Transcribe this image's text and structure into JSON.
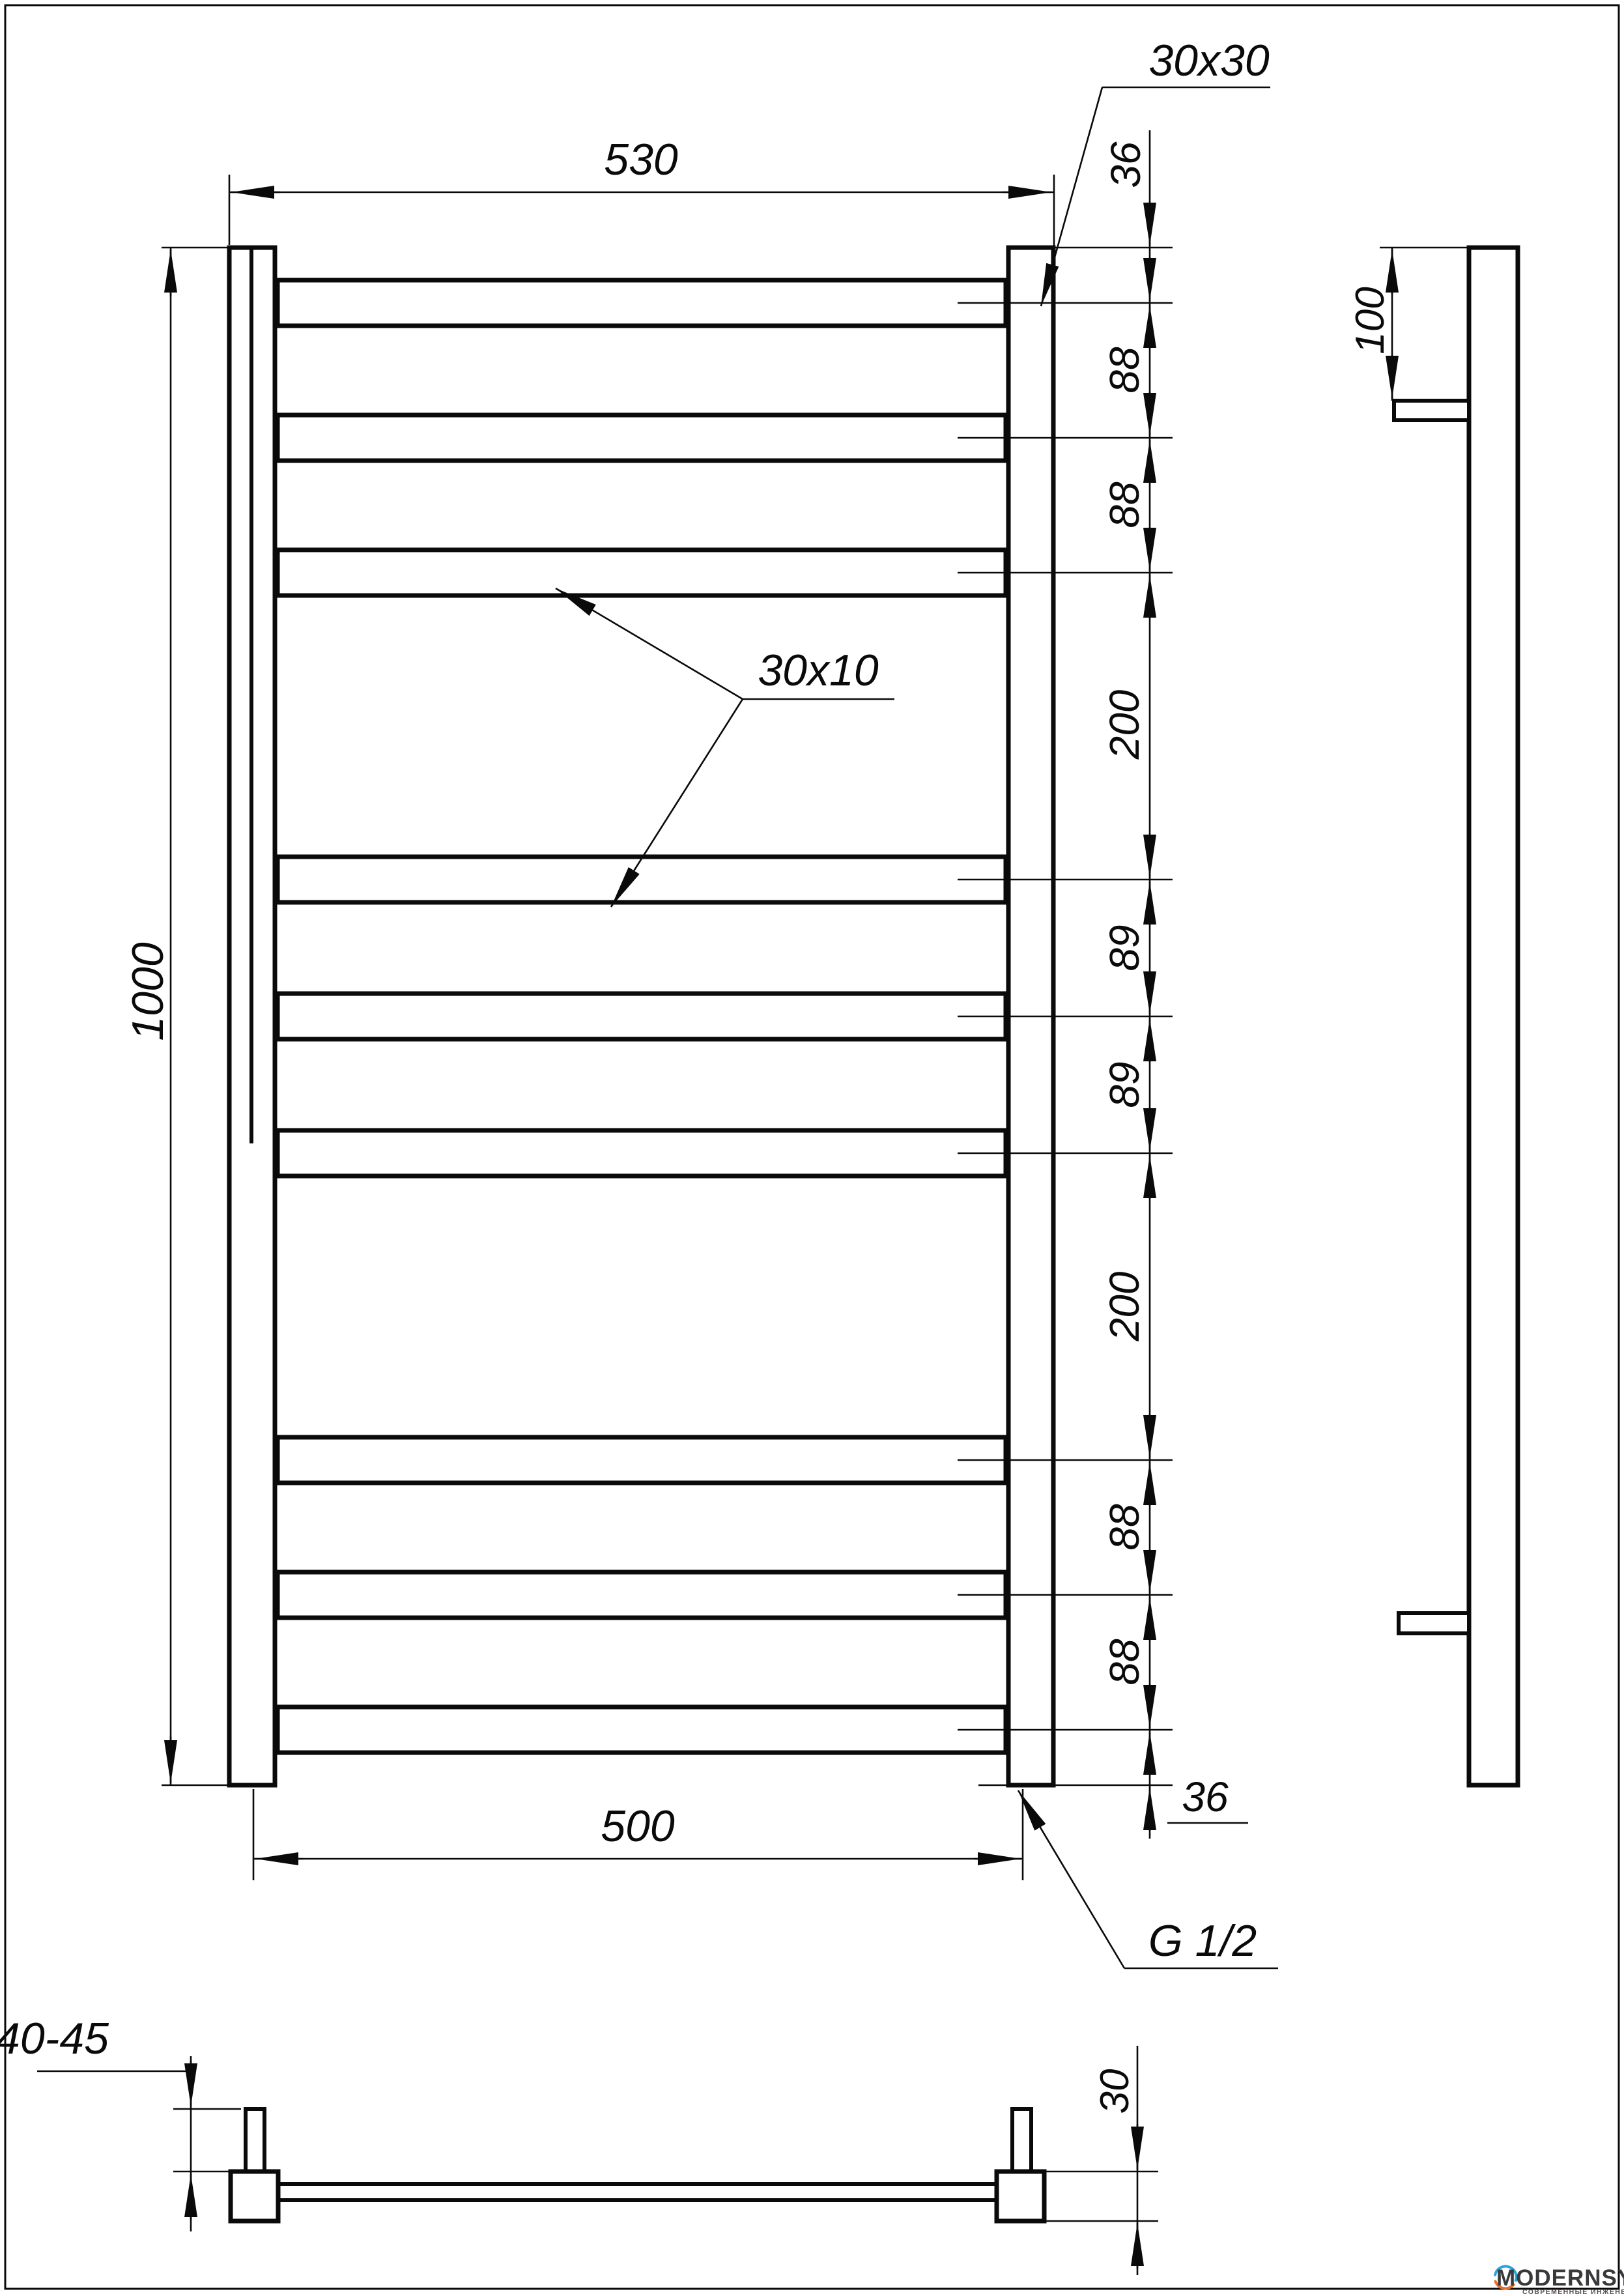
{
  "front_view": {
    "dim_width_top": "530",
    "dim_width_bottom": "500",
    "dim_height": "1000",
    "label_post_profile": "30x30",
    "label_rung_profile": "30x10",
    "dim_top_offset": "36",
    "chain_segments": [
      "88",
      "88",
      "200",
      "89",
      "89",
      "200",
      "88",
      "88"
    ],
    "dim_bottom_offset": "36",
    "label_thread": "G 1/2"
  },
  "side_view": {
    "dim_bracket_offset": "100"
  },
  "bottom_view": {
    "dim_wall_distance": "40-45",
    "dim_profile": "30"
  },
  "logo": {
    "brand": "MODERNSYS",
    "tagline": "СОВРЕМЕННЫЕ ИНЖЕНЕРНЫЕ СИСТЕМЫ"
  }
}
